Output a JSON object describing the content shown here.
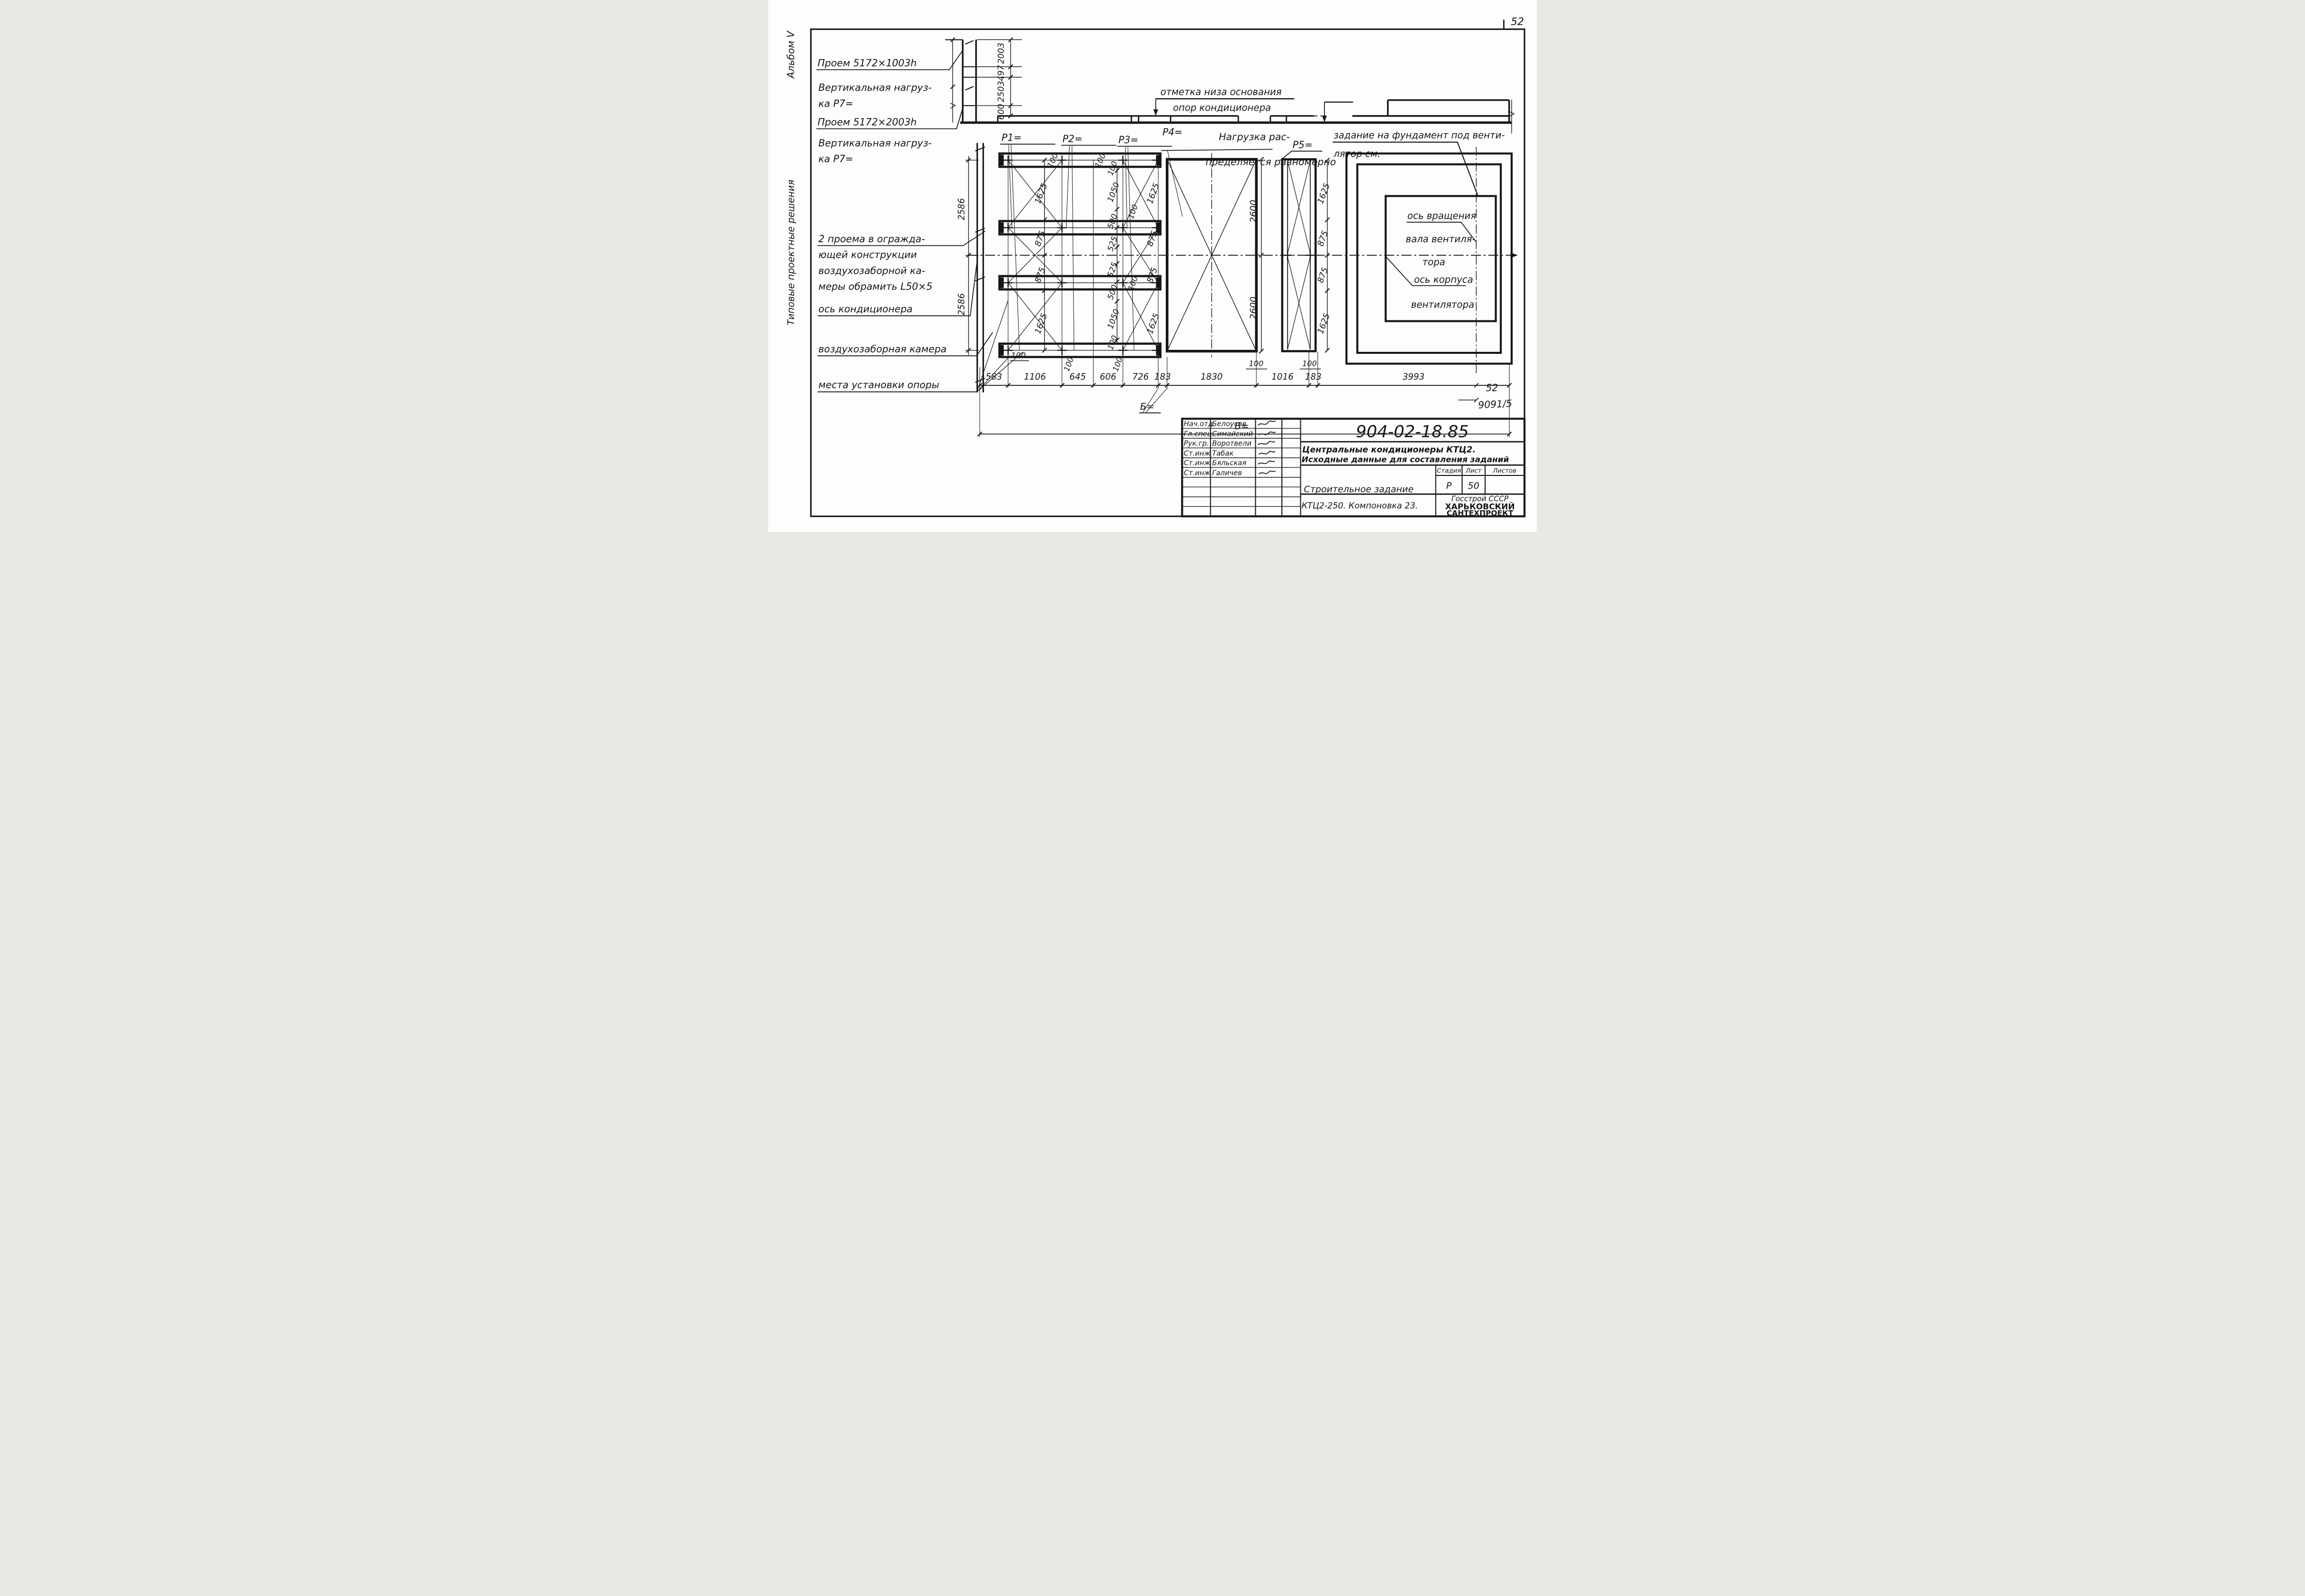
{
  "page": {
    "number_top": "52"
  },
  "margin": {
    "album": "Альбом V",
    "series": "Типовые проектные решения"
  },
  "notes": {
    "opening1": "Проем 5172×1003h",
    "load1a": "Вертикальная нагруз-",
    "load1b": "ка Р7=",
    "opening2": "Проем 5172×2003h",
    "load2a": "Вертикальная нагруз-",
    "load2b": "ка Р7=",
    "frame1": "2 проема в огражда-",
    "frame2": "ющей конструкции",
    "frame3": "воздухозаборной ка-",
    "frame4": "меры обрамить L50×5",
    "axis": "ось кондиционера",
    "chamber": "воздухозаборная камера",
    "supports": "места установки опоры"
  },
  "elevation": {
    "mark1": "отметка низа основания",
    "mark2": "опор кондиционера",
    "dims": [
      "2003",
      "497",
      "2503",
      "600"
    ]
  },
  "plan": {
    "p1": "Р1=",
    "p2": "Р2=",
    "p3": "Р3=",
    "p4": "Р4=",
    "p5": "Р5=",
    "load_note1": "Нагрузка рас-",
    "load_note2": "пределяется равномерно",
    "fan_task1": "задание на фундамент под венти-",
    "fan_task2": "лятор см.",
    "fan_axis1": "ось вращения",
    "fan_axis2": "вала вентиля-",
    "fan_axis3": "тора",
    "fan_body1": "ось корпуса",
    "fan_body2": "вентилятора",
    "wall_dims": [
      "2586",
      "2586"
    ],
    "top_offsets": [
      "100",
      "100"
    ],
    "chainA": [
      "1625",
      "875",
      "875",
      "1625"
    ],
    "chainB": [
      "100",
      "1050",
      "500",
      "525",
      "525",
      "500",
      "1050",
      "100"
    ],
    "chainB_extra": [
      "100",
      "100"
    ],
    "chain2600": [
      "2600",
      "2600"
    ],
    "chainD": [
      "1625",
      "875",
      "875",
      "1625"
    ],
    "small100": [
      "100",
      "100",
      "100",
      "100",
      "100"
    ],
    "bottom_chain": [
      "583",
      "1106",
      "645",
      "606",
      "726",
      "183",
      "1830",
      "1016",
      "183",
      "3993"
    ],
    "total_label": "В=",
    "b_label": "Б=",
    "corner_num": "52",
    "inv_num": "9091/5"
  },
  "titleblock": {
    "doc_number": "904-02-18.85",
    "title1": "Центральные кондиционеры КТЦ2.",
    "title2": "Исходные данные для составления заданий",
    "doc_type": "Строительное задание",
    "config": "КТЦ2-250. Компоновка 23.",
    "stage_label": "Стадия",
    "sheet_label": "Лист",
    "sheets_label": "Листов",
    "stage": "Р",
    "sheet": "50",
    "org1": "Госстрой СССР",
    "org2": "ХАРЬКОВСКИЙ",
    "org3": "САНТЕХПРОЕКТ",
    "rows": [
      {
        "role": "Нач.отд",
        "name": "Белоусов"
      },
      {
        "role": "Гл.спец.",
        "name": "Симайский"
      },
      {
        "role": "Рук.гр.",
        "name": "Воротвели"
      },
      {
        "role": "Ст.инж",
        "name": "Табак"
      },
      {
        "role": "Ст.инж",
        "name": "Бяльская"
      },
      {
        "role": "Ст.инж",
        "name": "Галичев"
      }
    ]
  }
}
